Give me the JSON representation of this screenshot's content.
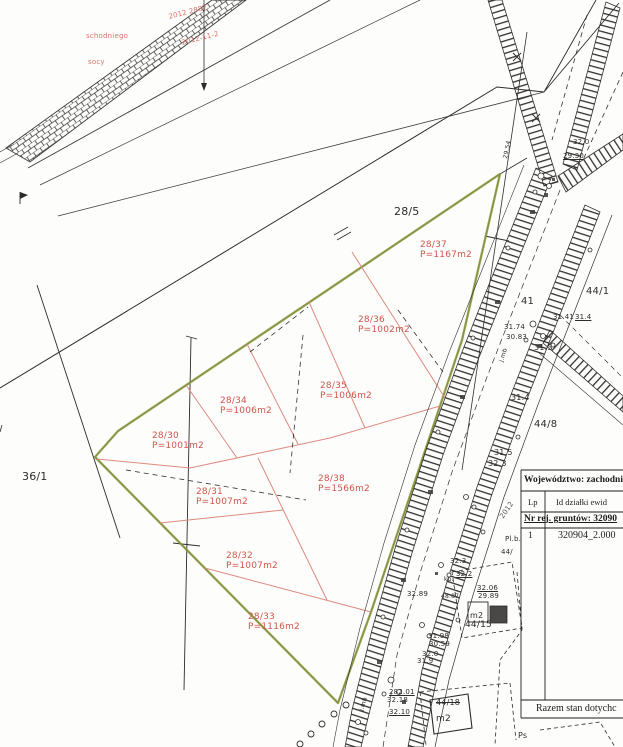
{
  "colors": {
    "ink": "#2e2c2a",
    "ink_light": "#565450",
    "red_label": "#cf564d",
    "red_line": "#dd8a80",
    "stamp_red": "#d8736c",
    "green_boundary": "#8d9a3f",
    "paper": "#fdfdfb"
  },
  "table": {
    "wojewodztwo": "Województwo: zachodni",
    "col_lp": "Lp",
    "col_id": "Id działki ewid",
    "nr_rej": "Nr rej. gruntów: 32090",
    "row1_lp": "1",
    "row1_id": "320904_2.000",
    "razem": "Razem stan dotychc"
  },
  "parcel_labels": [
    {
      "name": "parcel-label-28-37",
      "no": "28/37",
      "area": "P=1167m2",
      "x": 420,
      "y": 240
    },
    {
      "name": "parcel-label-28-36",
      "no": "28/36",
      "area": "P=1002m2",
      "x": 358,
      "y": 315
    },
    {
      "name": "parcel-label-28-35",
      "no": "28/35",
      "area": "P=1006m2",
      "x": 320,
      "y": 381
    },
    {
      "name": "parcel-label-28-34",
      "no": "28/34",
      "area": "P=1006m2",
      "x": 220,
      "y": 396
    },
    {
      "name": "parcel-label-28-30",
      "no": "28/30",
      "area": "P=1001m2",
      "x": 152,
      "y": 431
    },
    {
      "name": "parcel-label-28-31",
      "no": "28/31",
      "area": "P=1007m2",
      "x": 196,
      "y": 487
    },
    {
      "name": "parcel-label-28-38",
      "no": "28/38",
      "area": "P=1566m2",
      "x": 318,
      "y": 474
    },
    {
      "name": "parcel-label-28-32",
      "no": "28/32",
      "area": "P=1007m2",
      "x": 226,
      "y": 551
    },
    {
      "name": "parcel-label-28-33",
      "no": "28/33",
      "area": "P=1116m2",
      "x": 248,
      "y": 612
    }
  ],
  "labels": [
    {
      "name": "parcel-label-28-5",
      "t": "28/5",
      "x": 394,
      "y": 206,
      "s": 11,
      "c": "k"
    },
    {
      "name": "parcel-label-36-1",
      "t": "36/1",
      "x": 22,
      "y": 471,
      "s": 11,
      "c": "k"
    },
    {
      "name": "parcel-label-44-1",
      "t": "44/1",
      "x": 586,
      "y": 286,
      "s": 10,
      "c": "k"
    },
    {
      "name": "parcel-label-44-8",
      "t": "44/8",
      "x": 534,
      "y": 419,
      "s": 10,
      "c": "k"
    },
    {
      "name": "parcel-label-41",
      "t": "41",
      "x": 521,
      "y": 296,
      "s": 10,
      "c": "k"
    },
    {
      "name": "elevation-label",
      "t": "32.0",
      "x": 573,
      "y": 139,
      "s": 7,
      "c": "k"
    },
    {
      "name": "elevation-label",
      "t": "29.30",
      "x": 563,
      "y": 153,
      "s": 7,
      "c": "k",
      "u": 1
    },
    {
      "name": "elevation-label",
      "t": "31.74",
      "x": 504,
      "y": 324,
      "s": 7,
      "c": "k"
    },
    {
      "name": "elevation-label",
      "t": "30.83",
      "x": 506,
      "y": 334,
      "s": 7,
      "c": "k"
    },
    {
      "name": "elevation-label",
      "t": "31.3",
      "x": 534,
      "y": 344,
      "s": 8,
      "c": "k"
    },
    {
      "name": "elevation-label",
      "t": "31.41",
      "x": 553,
      "y": 314,
      "s": 7,
      "c": "k"
    },
    {
      "name": "elevation-label",
      "t": "31.4",
      "x": 575,
      "y": 314,
      "s": 7,
      "c": "k",
      "u": 1
    },
    {
      "name": "elevation-label",
      "t": "31.4",
      "x": 511,
      "y": 394,
      "s": 8,
      "c": "k"
    },
    {
      "name": "elevation-label",
      "t": "31.5",
      "x": 494,
      "y": 449,
      "s": 8,
      "c": "k"
    },
    {
      "name": "elevation-label",
      "t": "32.3",
      "x": 488,
      "y": 460,
      "s": 8,
      "c": "k"
    },
    {
      "name": "elevation-label",
      "t": "32.3",
      "x": 450,
      "y": 558,
      "s": 7,
      "c": "k"
    },
    {
      "name": "elevation-label",
      "t": "32.2",
      "x": 456,
      "y": 571,
      "s": 7,
      "c": "k",
      "u": 1
    },
    {
      "name": "map-note",
      "t": "kp.",
      "x": 444,
      "y": 577,
      "s": 6,
      "c": "k"
    },
    {
      "name": "elevation-label",
      "t": "32.89",
      "x": 407,
      "y": 591,
      "s": 7,
      "c": "k"
    },
    {
      "name": "elevation-label",
      "t": "48.87",
      "x": 441,
      "y": 594,
      "s": 6,
      "c": "k"
    },
    {
      "name": "elevation-label",
      "t": "32.06",
      "x": 477,
      "y": 585,
      "s": 7,
      "c": "k",
      "u": 1
    },
    {
      "name": "elevation-label",
      "t": "29.89",
      "x": 478,
      "y": 593,
      "s": 7,
      "c": "k"
    },
    {
      "name": "area-unit-label",
      "t": "m2",
      "x": 470,
      "y": 612,
      "s": 8,
      "c": "k"
    },
    {
      "name": "parcel-label-44-15",
      "t": "44/15",
      "x": 465,
      "y": 620,
      "s": 9,
      "c": "k"
    },
    {
      "name": "elevation-label",
      "t": "31.98",
      "x": 428,
      "y": 633,
      "s": 7,
      "c": "k"
    },
    {
      "name": "elevation-label",
      "t": "30.59",
      "x": 429,
      "y": 641,
      "s": 7,
      "c": "k"
    },
    {
      "name": "elevation-label",
      "t": "32.0",
      "x": 422,
      "y": 651,
      "s": 7,
      "c": "k"
    },
    {
      "name": "elevation-label",
      "t": "31.9",
      "x": 417,
      "y": 658,
      "s": 7,
      "c": "k"
    },
    {
      "name": "distance-label",
      "t": "282.01",
      "x": 389,
      "y": 689,
      "s": 7,
      "c": "k",
      "u": 1
    },
    {
      "name": "elevation-label",
      "t": "32.18",
      "x": 387,
      "y": 697,
      "s": 7,
      "c": "k"
    },
    {
      "name": "elevation-label",
      "t": "32.10",
      "x": 389,
      "y": 709,
      "s": 7,
      "c": "k",
      "u": 1
    },
    {
      "name": "parcel-label-44-18",
      "t": "44/18",
      "x": 436,
      "y": 699,
      "s": 8,
      "c": "k",
      "st": 1
    },
    {
      "name": "area-unit-label",
      "t": "m2",
      "x": 436,
      "y": 714,
      "s": 9,
      "c": "k"
    },
    {
      "name": "land-use-label",
      "t": "Ps",
      "x": 518,
      "y": 732,
      "s": 8,
      "c": "k"
    },
    {
      "name": "road-note",
      "t": "j.mb",
      "x": 499,
      "y": 361,
      "s": 6,
      "c": "k",
      "r": -72
    },
    {
      "name": "road-note",
      "t": "j.mb",
      "x": 359,
      "y": 710,
      "s": 6,
      "c": "k",
      "r": -72
    },
    {
      "name": "road-note",
      "t": "29.54",
      "x": 503,
      "y": 158,
      "s": 6,
      "c": "k",
      "r": -78
    },
    {
      "name": "stamp-text",
      "t": "2012 2887",
      "x": 168,
      "y": 14,
      "s": 7,
      "c": "s",
      "r": -14
    },
    {
      "name": "stamp-text",
      "t": "schodniego",
      "x": 86,
      "y": 33,
      "s": 7,
      "c": "s"
    },
    {
      "name": "stamp-text",
      "t": "2012-11-2",
      "x": 181,
      "y": 40,
      "s": 7,
      "c": "s",
      "r": -14
    },
    {
      "name": "stamp-text",
      "t": "socy",
      "x": 88,
      "y": 59,
      "s": 7,
      "c": "s"
    },
    {
      "name": "stamp-text",
      "t": "2012",
      "x": 499,
      "y": 516,
      "s": 7,
      "c": "g",
      "r": -55
    },
    {
      "name": "map-note",
      "t": "Pl.b.",
      "x": 505,
      "y": 536,
      "s": 7,
      "c": "k"
    },
    {
      "name": "map-note",
      "t": "44/",
      "x": 501,
      "y": 549,
      "s": 7,
      "c": "k"
    }
  ]
}
